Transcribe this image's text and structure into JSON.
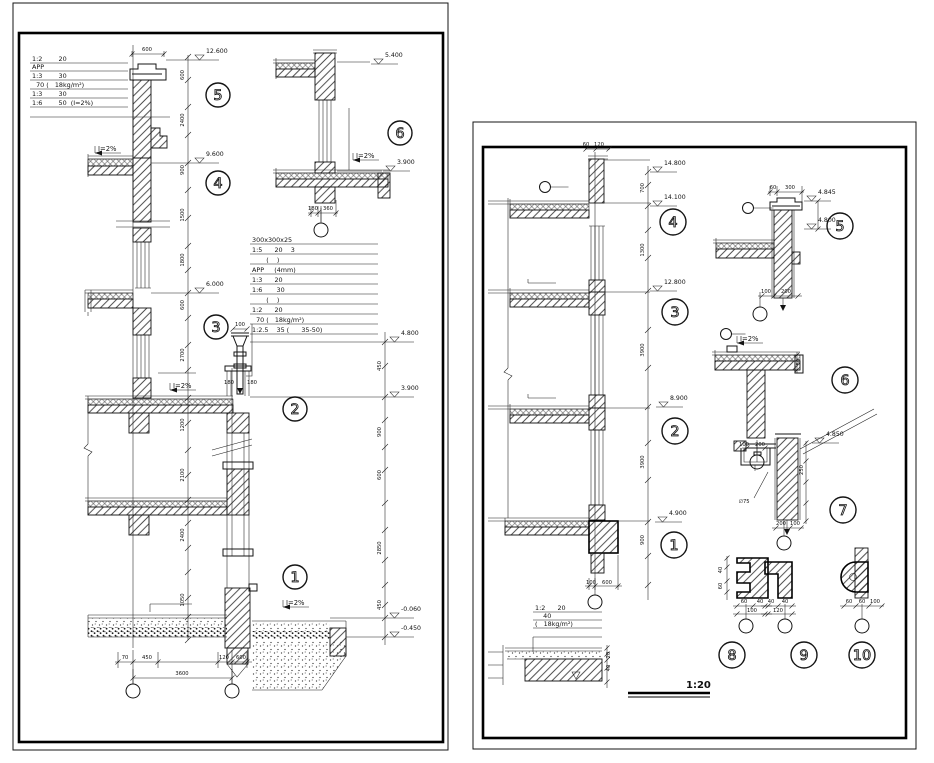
{
  "left": {
    "table_top": {
      "rows": [
        "1:2        20",
        "APP",
        "1:3        30",
        "  70 (   18kg/m²)",
        "1:3        30",
        "1:6        50  (I=2%)"
      ]
    },
    "table_mid": {
      "header": "300x300x25",
      "rows": [
        "1:5      20    3",
        "       (    )",
        "APP     (4mm)",
        "1:3      20",
        "1:6       30",
        "       (    )",
        "1:2      20",
        "  70 (   18kg/m²)",
        "1:2.5    35 (      35-50)"
      ]
    },
    "dims": [
      {
        "x": 147,
        "y": 51,
        "t": "600"
      },
      {
        "x": 240,
        "y": 326,
        "t": "100"
      },
      {
        "x": 229,
        "y": 384,
        "t": "180"
      },
      {
        "x": 252,
        "y": 384,
        "t": "180"
      },
      {
        "x": 125,
        "y": 659,
        "t": "70"
      },
      {
        "x": 147,
        "y": 659,
        "t": "450"
      },
      {
        "x": 224,
        "y": 659,
        "t": "120"
      },
      {
        "x": 241,
        "y": 659,
        "t": "600"
      },
      {
        "x": 182,
        "y": 675,
        "t": "3600"
      },
      {
        "x": 313,
        "y": 210,
        "t": "180"
      },
      {
        "x": 328,
        "y": 210,
        "t": "360"
      },
      {
        "x": 184,
        "y": 75,
        "t": "600",
        "r": -90
      },
      {
        "x": 184,
        "y": 120,
        "t": "2400",
        "r": -90
      },
      {
        "x": 184,
        "y": 170,
        "t": "900",
        "r": -90
      },
      {
        "x": 184,
        "y": 215,
        "t": "1500",
        "r": -90
      },
      {
        "x": 184,
        "y": 260,
        "t": "1800",
        "r": -90
      },
      {
        "x": 184,
        "y": 305,
        "t": "600",
        "r": -90
      },
      {
        "x": 184,
        "y": 355,
        "t": "2700",
        "r": -90
      },
      {
        "x": 184,
        "y": 425,
        "t": "1200",
        "r": -90
      },
      {
        "x": 184,
        "y": 475,
        "t": "2100",
        "r": -90
      },
      {
        "x": 184,
        "y": 535,
        "t": "2400",
        "r": -90
      },
      {
        "x": 184,
        "y": 600,
        "t": "1050",
        "r": -90
      },
      {
        "x": 381,
        "y": 366,
        "t": "450",
        "r": -90
      },
      {
        "x": 381,
        "y": 432,
        "t": "900",
        "r": -90
      },
      {
        "x": 381,
        "y": 475,
        "t": "600",
        "r": -90
      },
      {
        "x": 381,
        "y": 548,
        "t": "2850",
        "r": -90
      },
      {
        "x": 381,
        "y": 605,
        "t": "450",
        "r": -90
      }
    ],
    "elevations": [
      {
        "x": 192,
        "y": 60,
        "v": "12.600"
      },
      {
        "x": 192,
        "y": 163,
        "v": "9.600"
      },
      {
        "x": 192,
        "y": 293,
        "v": "6.000"
      },
      {
        "x": 387,
        "y": 342,
        "v": "4.800"
      },
      {
        "x": 387,
        "y": 397,
        "v": "3.900"
      },
      {
        "x": 387,
        "y": 618,
        "v": "-0.060"
      },
      {
        "x": 387,
        "y": 637,
        "v": "-0.450"
      },
      {
        "x": 371,
        "y": 64,
        "v": "5.400"
      },
      {
        "x": 383,
        "y": 171,
        "v": "3.900"
      }
    ],
    "slopes": [
      {
        "x": 98,
        "y": 151,
        "label": "I=2%"
      },
      {
        "x": 173,
        "y": 388,
        "label": "I=2%"
      },
      {
        "x": 286,
        "y": 605,
        "label": "I=2%"
      },
      {
        "x": 356,
        "y": 158,
        "label": "I=2%"
      }
    ],
    "details": [
      {
        "x": 218,
        "y": 95,
        "n": "5"
      },
      {
        "x": 218,
        "y": 183,
        "n": "4"
      },
      {
        "x": 216,
        "y": 327,
        "n": "3"
      },
      {
        "x": 295,
        "y": 409,
        "n": "2"
      },
      {
        "x": 295,
        "y": 577,
        "n": "1"
      },
      {
        "x": 400,
        "y": 133,
        "n": "6"
      }
    ],
    "grid_bubbles": [
      {
        "x": 133,
        "y": 691
      },
      {
        "x": 232,
        "y": 691
      },
      {
        "x": 321,
        "y": 230
      }
    ],
    "leader_tags": []
  },
  "right": {
    "table_bottom": {
      "rows": [
        "1:2      20",
        "    40",
        "(   18kg/m²)"
      ]
    },
    "scale_label": "1:20",
    "dims": [
      {
        "x": 586,
        "y": 146,
        "t": "60"
      },
      {
        "x": 599,
        "y": 146,
        "t": "120"
      },
      {
        "x": 591,
        "y": 584,
        "t": "100"
      },
      {
        "x": 607,
        "y": 584,
        "t": "600"
      },
      {
        "x": 644,
        "y": 188,
        "t": "700",
        "r": -90
      },
      {
        "x": 644,
        "y": 250,
        "t": "1300",
        "r": -90
      },
      {
        "x": 644,
        "y": 350,
        "t": "3900",
        "r": -90
      },
      {
        "x": 644,
        "y": 462,
        "t": "3900",
        "r": -90
      },
      {
        "x": 644,
        "y": 540,
        "t": "900",
        "r": -90
      },
      {
        "x": 773,
        "y": 189,
        "t": "60"
      },
      {
        "x": 790,
        "y": 189,
        "t": "300"
      },
      {
        "x": 766,
        "y": 293,
        "t": "100"
      },
      {
        "x": 786,
        "y": 293,
        "t": "200"
      },
      {
        "x": 744,
        "y": 446,
        "t": "100"
      },
      {
        "x": 760,
        "y": 446,
        "t": "200"
      },
      {
        "x": 800,
        "y": 362,
        "t": "50",
        "r": -90
      },
      {
        "x": 744,
        "y": 503,
        "t": "∅75"
      },
      {
        "x": 781,
        "y": 525,
        "t": "200"
      },
      {
        "x": 795,
        "y": 525,
        "t": "100"
      },
      {
        "x": 803,
        "y": 470,
        "t": "250",
        "r": -90
      },
      {
        "x": 744,
        "y": 603,
        "t": "60"
      },
      {
        "x": 760,
        "y": 603,
        "t": "40"
      },
      {
        "x": 752,
        "y": 612,
        "t": "100"
      },
      {
        "x": 722,
        "y": 570,
        "t": "40",
        "r": -90
      },
      {
        "x": 722,
        "y": 586,
        "t": "60",
        "r": -90
      },
      {
        "x": 771,
        "y": 603,
        "t": "40"
      },
      {
        "x": 785,
        "y": 603,
        "t": "40"
      },
      {
        "x": 778,
        "y": 612,
        "t": "120"
      },
      {
        "x": 849,
        "y": 603,
        "t": "60"
      },
      {
        "x": 862,
        "y": 603,
        "t": "60"
      },
      {
        "x": 875,
        "y": 603,
        "t": "100"
      },
      {
        "x": 610,
        "y": 655,
        "t": "20",
        "r": -90
      },
      {
        "x": 610,
        "y": 668,
        "t": "40",
        "r": -90
      }
    ],
    "elevations": [
      {
        "x": 650,
        "y": 172,
        "v": "14.800"
      },
      {
        "x": 650,
        "y": 206,
        "v": "14.100"
      },
      {
        "x": 650,
        "y": 291,
        "v": "12.800"
      },
      {
        "x": 656,
        "y": 407,
        "v": "8.900"
      },
      {
        "x": 655,
        "y": 522,
        "v": "4.900"
      },
      {
        "x": 804,
        "y": 201,
        "v": "4.845"
      },
      {
        "x": 804,
        "y": 229,
        "v": "4.800"
      },
      {
        "x": 812,
        "y": 443,
        "v": "4.850"
      }
    ],
    "slopes": [
      {
        "x": 740,
        "y": 341,
        "label": "I=2%"
      }
    ],
    "details": [
      {
        "x": 673,
        "y": 222,
        "n": "4"
      },
      {
        "x": 675,
        "y": 312,
        "n": "3"
      },
      {
        "x": 675,
        "y": 431,
        "n": "2"
      },
      {
        "x": 674,
        "y": 545,
        "n": "1"
      },
      {
        "x": 840,
        "y": 226,
        "n": "5"
      },
      {
        "x": 845,
        "y": 380,
        "n": "6"
      },
      {
        "x": 843,
        "y": 510,
        "n": "7"
      },
      {
        "x": 732,
        "y": 655,
        "n": "8"
      },
      {
        "x": 804,
        "y": 655,
        "n": "9"
      },
      {
        "x": 862,
        "y": 655,
        "n": "10"
      }
    ],
    "grid_bubbles": [
      {
        "x": 595,
        "y": 602
      },
      {
        "x": 760,
        "y": 314
      },
      {
        "x": 757,
        "y": 462
      },
      {
        "x": 784,
        "y": 543
      },
      {
        "x": 746,
        "y": 626
      },
      {
        "x": 785,
        "y": 626
      },
      {
        "x": 862,
        "y": 626
      }
    ],
    "leader_tags": [
      {
        "x": 545,
        "y": 187,
        "len": 18
      },
      {
        "x": 748,
        "y": 208,
        "len": 20
      },
      {
        "x": 726,
        "y": 334,
        "len": 14
      }
    ]
  }
}
